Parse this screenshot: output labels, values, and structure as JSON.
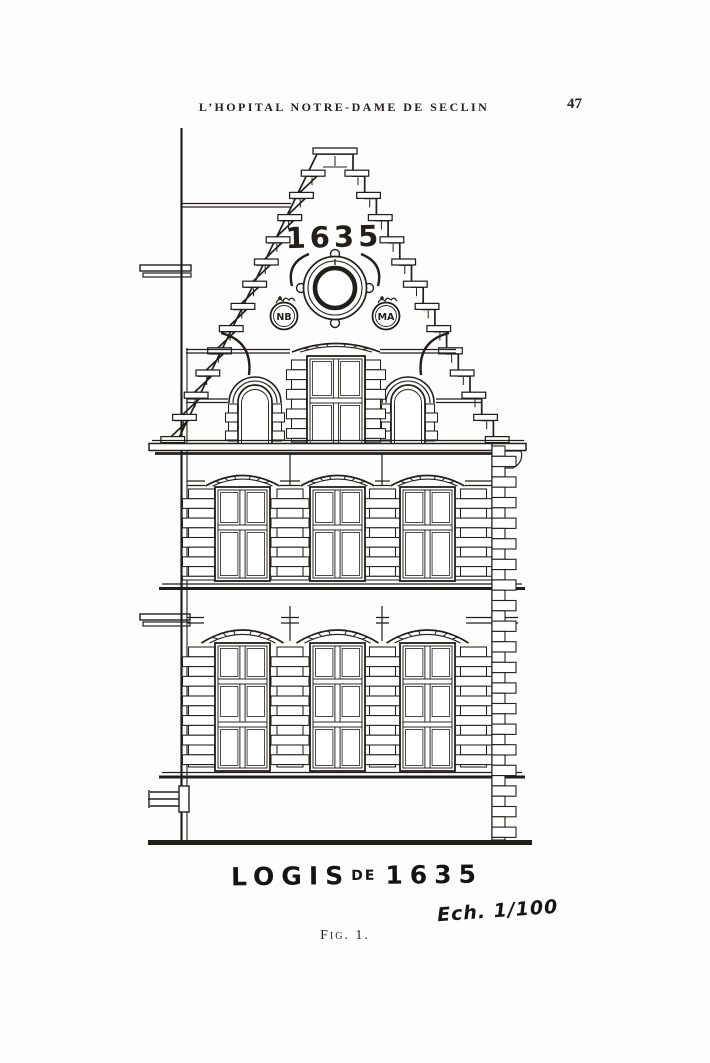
{
  "header": {
    "title": "L’HOPITAL NOTRE-DAME DE SECLIN",
    "page_number": "47"
  },
  "figure": {
    "date_inscription": "1635",
    "monograms": {
      "left": "NB",
      "right": "MA"
    },
    "caption": {
      "full_title": "LOGIS DE 1635",
      "title_word": "LOGIS",
      "title_connector": "DE",
      "title_year": "1635"
    },
    "scale_note": "Ech. 1/100",
    "figure_label": "Fig. 1."
  },
  "colors": {
    "ink": "#221f1b",
    "paper": "#fdfdfb"
  }
}
